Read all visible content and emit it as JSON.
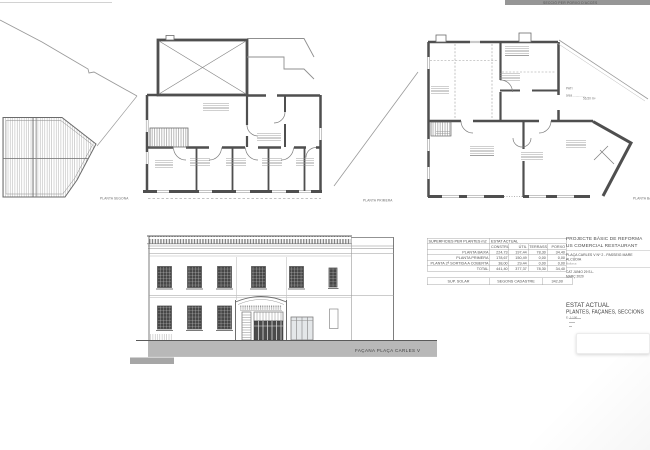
{
  "sheet": {
    "section_note": "SECCIÓ PER PORXO D'ACCÉS",
    "ink_color": "#4f4f4f",
    "sidewalk_color": "#b8b8b8"
  },
  "plans": {
    "planta_segona": {
      "label": "PLANTA SEGONA"
    },
    "planta_primera": {
      "label": "PLANTA PRIMERA"
    },
    "planta_baixa": {
      "label": "PLANTA BAIXA",
      "pati_label": "PATI",
      "pati_area_label": "àrea ..............",
      "pati_area_value": "56,50 m²"
    }
  },
  "facade": {
    "label": "FAÇANA PLAÇA CARLES V"
  },
  "surfaces_table": {
    "title": "SUPERFICIES PER PLANTES m2",
    "subtitle": "ESTAT ACTUAL",
    "columns": [
      "CONSTRUIDA",
      "ÚTIL",
      "TERRASSA",
      "PORXO"
    ],
    "rows": [
      {
        "label": "PLANTA BAIXA",
        "values": [
          "224,73",
          "197,44",
          "78,30",
          "34,40"
        ]
      },
      {
        "label": "PLANTA PRIMERA",
        "values": [
          "178,67",
          "150,49",
          "0,00",
          "0,00"
        ]
      },
      {
        "label": "PLANTA 2ª SORTIDA A COBERTA",
        "values": [
          "38,00",
          "29,44",
          "0,00",
          "0,00"
        ]
      },
      {
        "label": "TOTAL",
        "values": [
          "441,40",
          "377,37",
          "78,30",
          "34,40"
        ]
      }
    ],
    "footer": {
      "label": "SUP. SOLAR",
      "source": "SEGONS CADASTRE",
      "value": "342,00"
    }
  },
  "title_block": {
    "project_line1": "PROJECTE BÀSIC DE REFORMA",
    "project_line2": "US COMERCIAL RESTAURANT",
    "address_line1": "PLAÇA CARLES V Nº 2 - PASSEIG MARE",
    "address_line2": "ALCÚDIA",
    "address_line3": "Mallorca",
    "client": "CAT JUNIO 29 S.L.",
    "date": "MARÇ 2020",
    "sheet_title1": "ESTAT ACTUAL",
    "sheet_title2": "PLANTES, FAÇANES, SECCIONS",
    "scale": "E: 1:100"
  }
}
